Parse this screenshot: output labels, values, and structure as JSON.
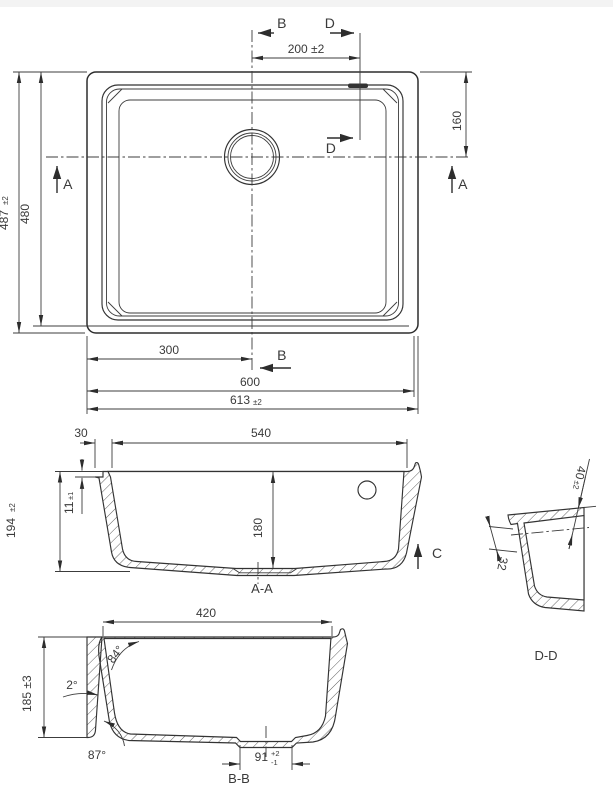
{
  "title": "Undermount sink dimensioned technical drawing",
  "colors": {
    "line": "#333333",
    "background": "#ffffff",
    "topbar": "#f3f3f3",
    "text": "#3a3a3a"
  },
  "plan": {
    "b_top": "B",
    "d_top": "D",
    "d_mid": "D",
    "b_bottom": "B",
    "a_left": "A",
    "a_right": "A",
    "dim_200": "200 ±2",
    "dim_160": "160",
    "dim_487": "487",
    "dim_487_tol": "±2",
    "dim_480": "480",
    "dim_300": "300",
    "dim_600": "600",
    "dim_613": "613",
    "dim_613_tol": "±2"
  },
  "section_aa": {
    "label": "A-A",
    "c_marker": "C",
    "dim_30": "30",
    "dim_540": "540",
    "dim_11": "11",
    "dim_11_tol": "±1",
    "dim_194": "194",
    "dim_194_tol": "±2",
    "dim_180": "180"
  },
  "detail_dd": {
    "label": "D-D",
    "dim_40": "40",
    "dim_40_tol": "±2",
    "dim_32": "32"
  },
  "section_bb": {
    "label": "B-B",
    "dim_420": "420",
    "dim_185": "185 ±3",
    "angle_84": "84°",
    "angle_2": "2°",
    "angle_87": "87°",
    "dim_91": "91",
    "dim_91_tol_plus": "+2",
    "dim_91_tol_minus": "-1"
  }
}
